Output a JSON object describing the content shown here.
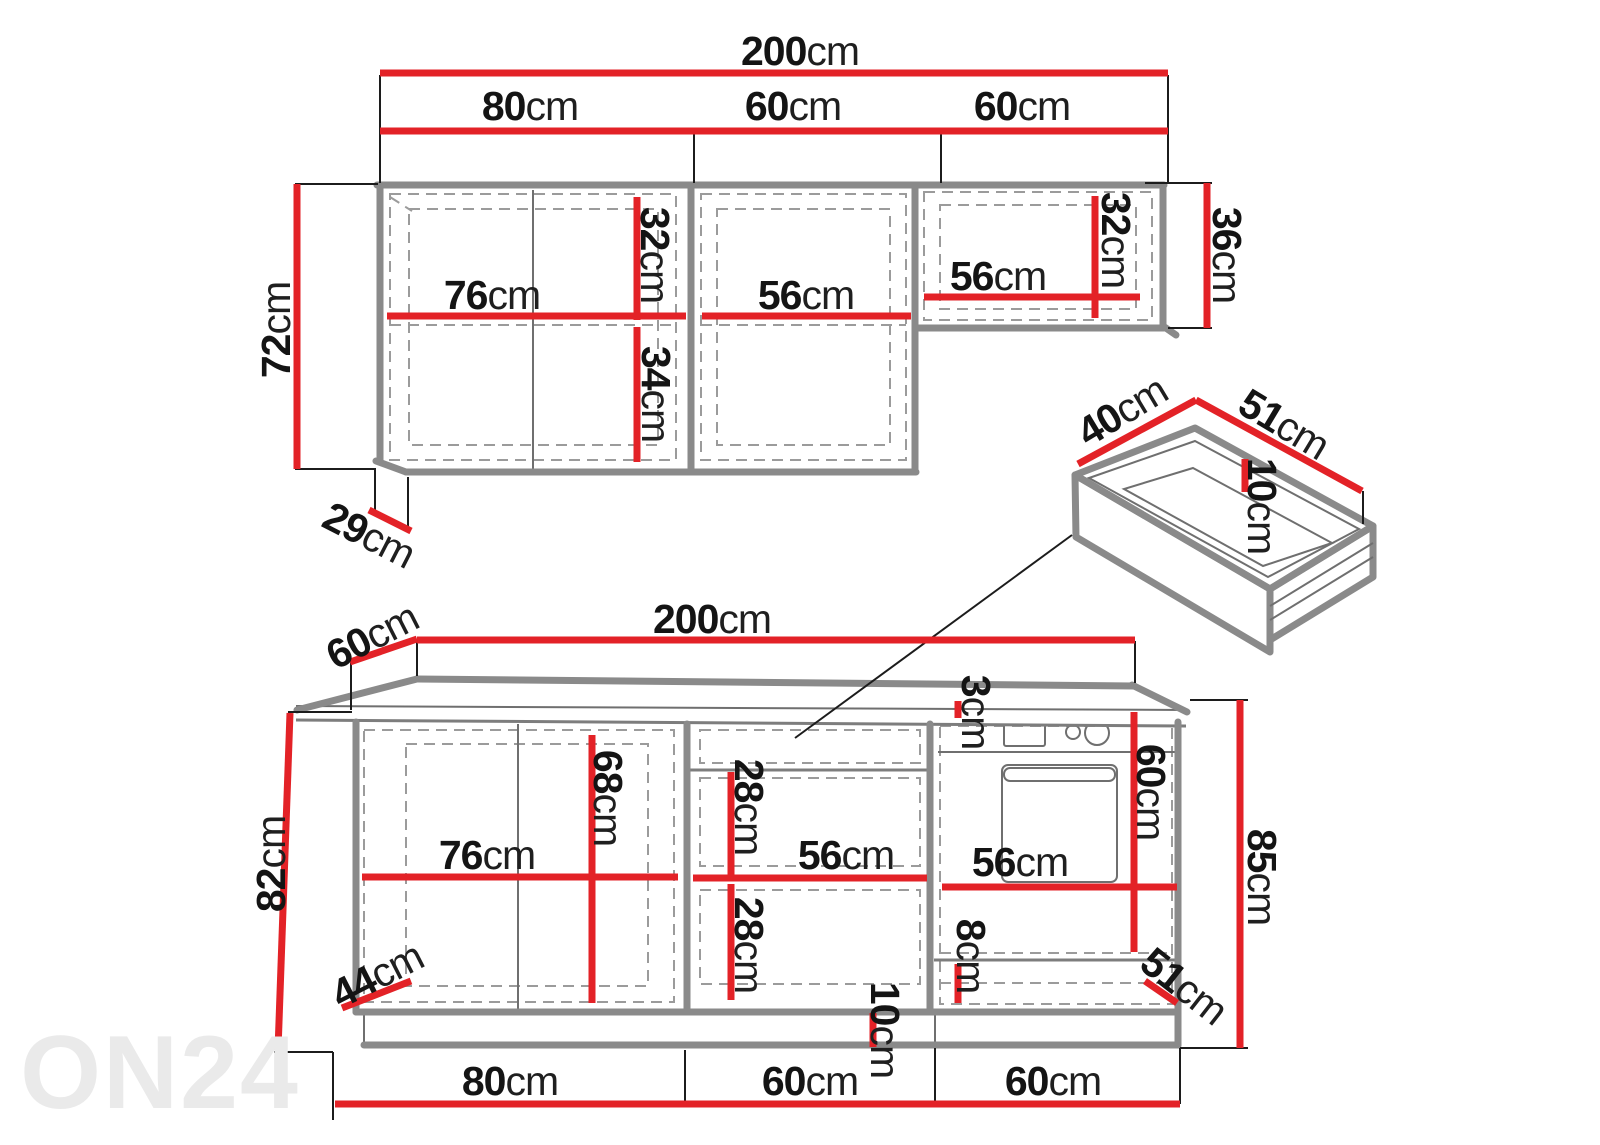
{
  "unit": "cm",
  "watermark": "ON24",
  "colors": {
    "dimension_red": "#e32227",
    "cabinet_outline_gray": "#8a8a8a",
    "detail_gray": "#6f6f6f",
    "dash_gray": "#9b9b9b",
    "tick_black": "#1c1c1c",
    "label_black": "#141414",
    "watermark_gray": "#eaeaea"
  },
  "upper_cabinet": {
    "total_width": "200",
    "section_widths": [
      "80",
      "60",
      "60"
    ],
    "height": "72",
    "depth": "29",
    "right_section_height": "36",
    "interior": {
      "left_width": "76",
      "left_top_height": "32",
      "left_bottom_height": "34",
      "middle_width": "56",
      "right_width": "56",
      "right_height": "32"
    }
  },
  "drawer": {
    "width": "40",
    "depth": "51",
    "height": "10"
  },
  "lower_cabinet": {
    "total_width": "200",
    "depth": "60",
    "countertop_thickness": "3",
    "front_height": "82",
    "total_height": "85",
    "section_widths": [
      "80",
      "60",
      "60"
    ],
    "interior": {
      "left_width": "76",
      "left_height": "68",
      "upper_drawer_height": "28",
      "drawer_width": "56",
      "lower_drawer_height": "28",
      "oven_width": "56",
      "oven_height": "60",
      "bottom_drawer_height": "8",
      "bottom_drawer_width": "51",
      "corner_depth": "44",
      "plinth_height": "10"
    }
  }
}
